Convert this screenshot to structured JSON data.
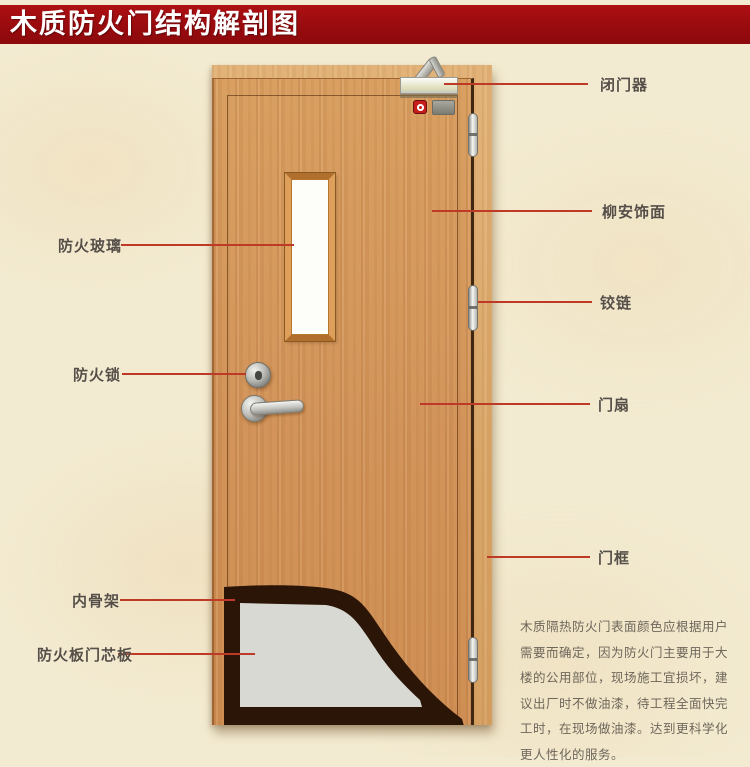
{
  "banner": {
    "title": "木质防火门结构解剖图",
    "bg_color": "#990b0e",
    "text_color": "#ffffff"
  },
  "labels": {
    "right": [
      {
        "id": "door-closer",
        "text": "闭门器"
      },
      {
        "id": "lauan-veneer",
        "text": "柳安饰面"
      },
      {
        "id": "hinge",
        "text": "铰链"
      },
      {
        "id": "door-leaf",
        "text": "门扇"
      },
      {
        "id": "door-frame",
        "text": "门框"
      }
    ],
    "left": [
      {
        "id": "fire-glass",
        "text": "防火玻璃"
      },
      {
        "id": "fire-lock",
        "text": "防火锁"
      },
      {
        "id": "inner-skeleton",
        "text": "内骨架"
      },
      {
        "id": "fire-board-core",
        "text": "防火板门芯板"
      }
    ]
  },
  "description": {
    "lines": [
      "木质隔热防火门表面颜色应根据用户",
      "需要而确定，因为防火门主要用于大",
      "楼的公用部位，现场施工宜损坏，建",
      "议出厂时不做油漆，待工程全面快完",
      "工时，在现场做油漆。达到更科学化",
      "更人性化的服务。"
    ]
  },
  "colors": {
    "leader_line": "#bf3a26",
    "label_text": "#564f47",
    "door_wood": "#d2945a",
    "frame_wood": "#d9a668",
    "background": "#f3ebd1",
    "core_panel_gray": "#d9d9d3",
    "skeleton_dark": "#2a1506"
  }
}
